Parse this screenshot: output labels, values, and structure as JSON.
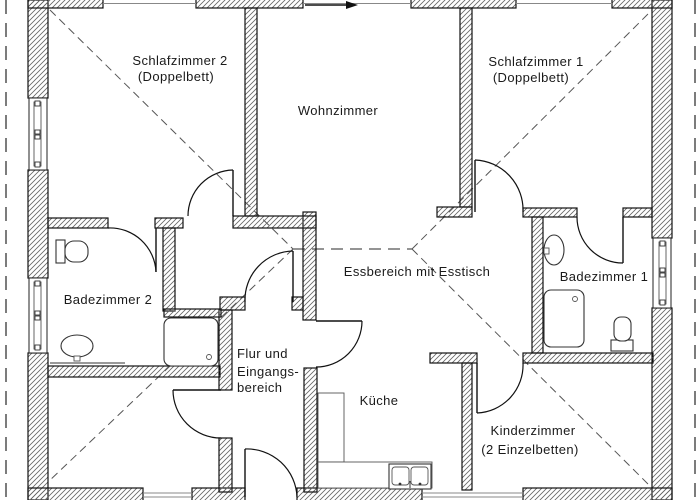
{
  "drawing": {
    "type": "floor-plan",
    "rooms": {
      "schlafzimmer2": {
        "lines": [
          "Schlafzimmer 2",
          "(Doppelbett)"
        ]
      },
      "wohnzimmer": {
        "lines": [
          "Wohnzimmer"
        ]
      },
      "schlafzimmer1": {
        "lines": [
          "Schlafzimmer 1",
          "(Doppelbett)"
        ]
      },
      "essbereich": {
        "lines": [
          "Essbereich mit Esstisch"
        ]
      },
      "badezimmer2": {
        "lines": [
          "Badezimmer 2"
        ]
      },
      "badezimmer1": {
        "lines": [
          "Badezimmer 1"
        ]
      },
      "flur": {
        "lines": [
          "Flur und",
          "Eingangs-",
          "bereich"
        ]
      },
      "kueche": {
        "lines": [
          "Küche"
        ]
      },
      "kinderzimmer": {
        "lines": [
          "Kinderzimmer",
          "(2 Einzelbetten)"
        ]
      }
    },
    "colors": {
      "background": "#ffffff",
      "wall_stroke": "#111111",
      "hatch": "#666666",
      "dashed_lines": "#555555",
      "text": "#1a1a1a"
    }
  }
}
